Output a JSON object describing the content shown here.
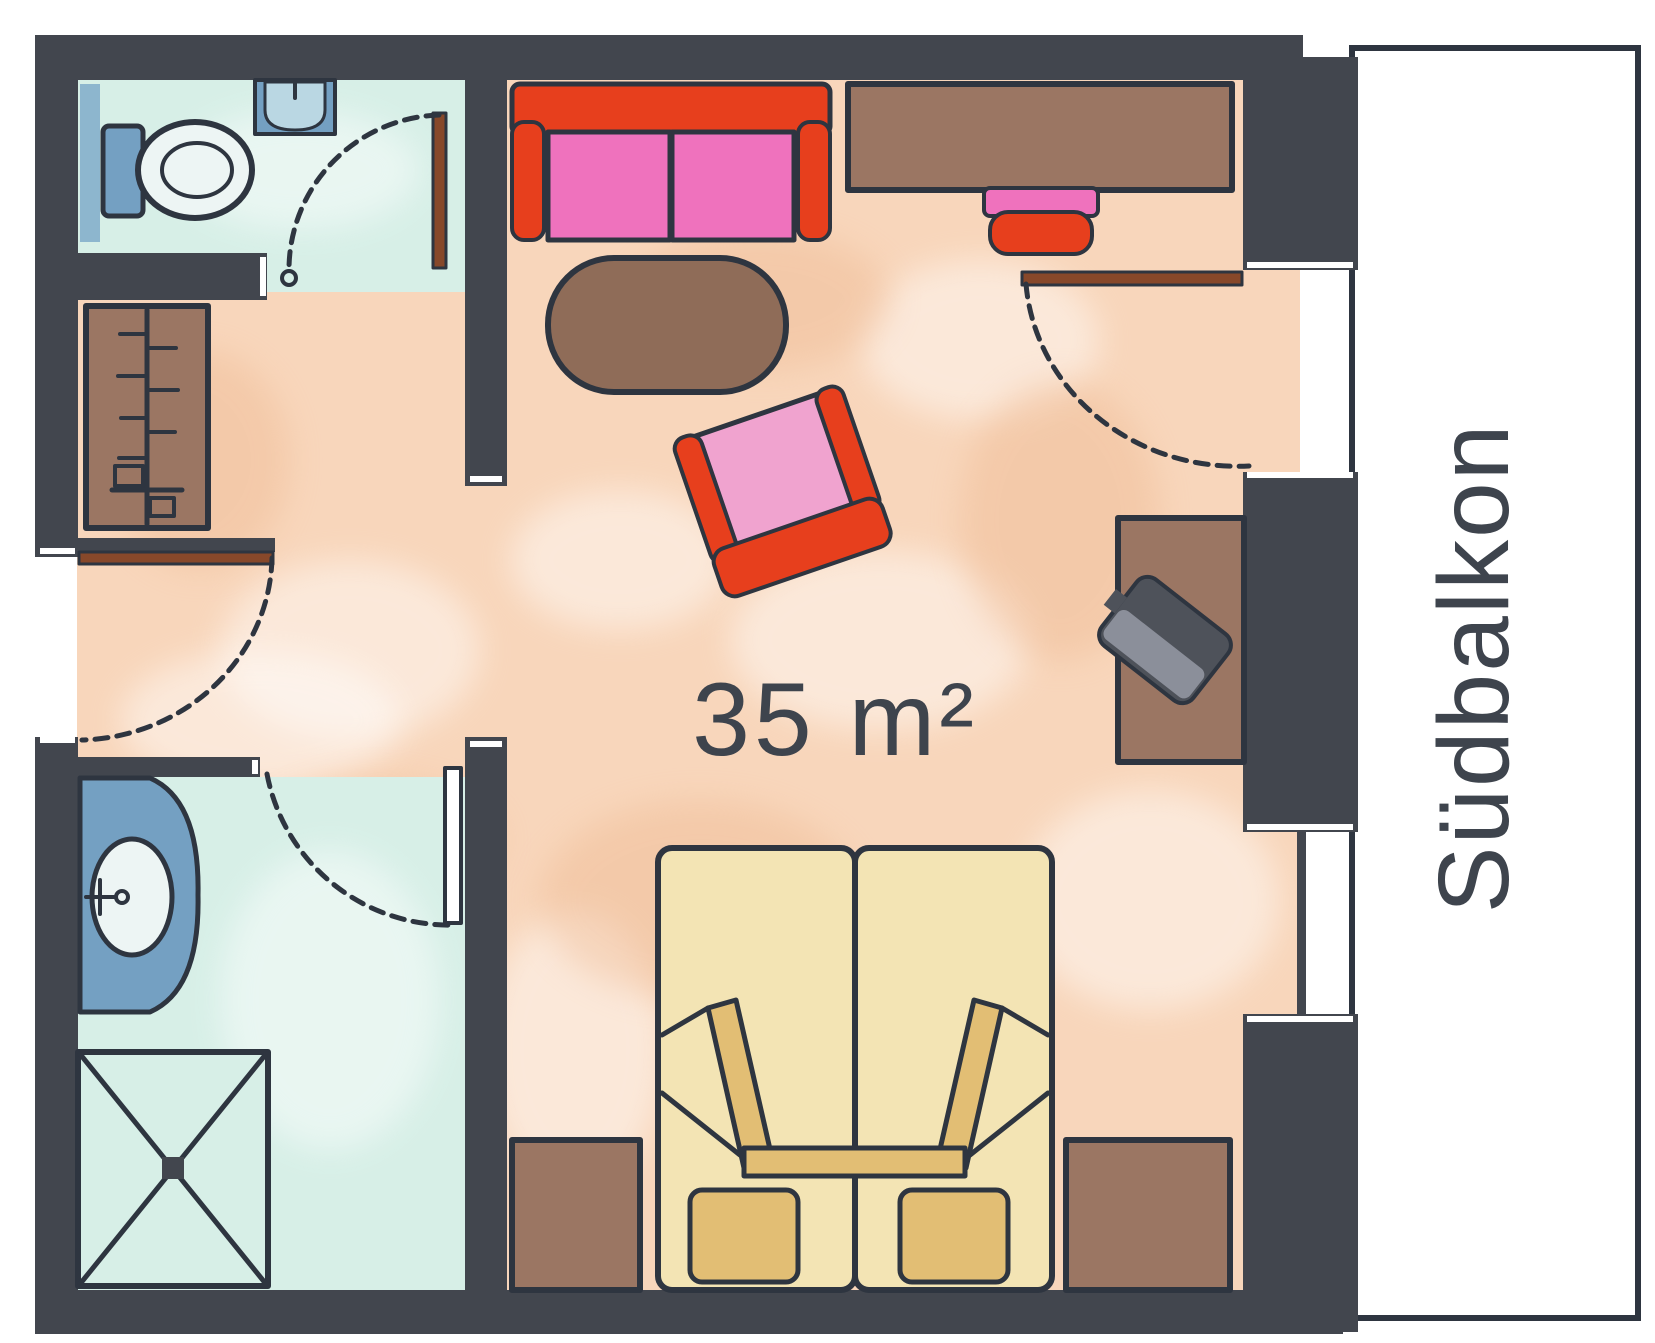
{
  "labels": {
    "area": "35 m²",
    "balcony": "Südbalkon"
  },
  "palette": {
    "paper": "#ffffff",
    "wall": "#42464e",
    "outline": "#2e3540",
    "floor-main": "#f8d6bb",
    "floor-bath": "#d7efe7",
    "fixture-blue": "#74a0c2",
    "fixture-blue-light": "#bad7e3",
    "fixture-white": "#edf5f4",
    "radiator-blue": "#8db6ce",
    "furn-brown": "#9b7663",
    "rug-brown": "#8f6c58",
    "sofa-red": "#e73f1d",
    "cushion-pink": "#ef72bd",
    "chair-pink": "#f0a3cf",
    "bed-tan": "#f3e4b4",
    "bed-tan-dark": "#e2be74",
    "door-leaf": "#87482a",
    "tv-dark": "#4e525a",
    "tv-light": "#969aa6",
    "label-ink": "#3e444d"
  }
}
